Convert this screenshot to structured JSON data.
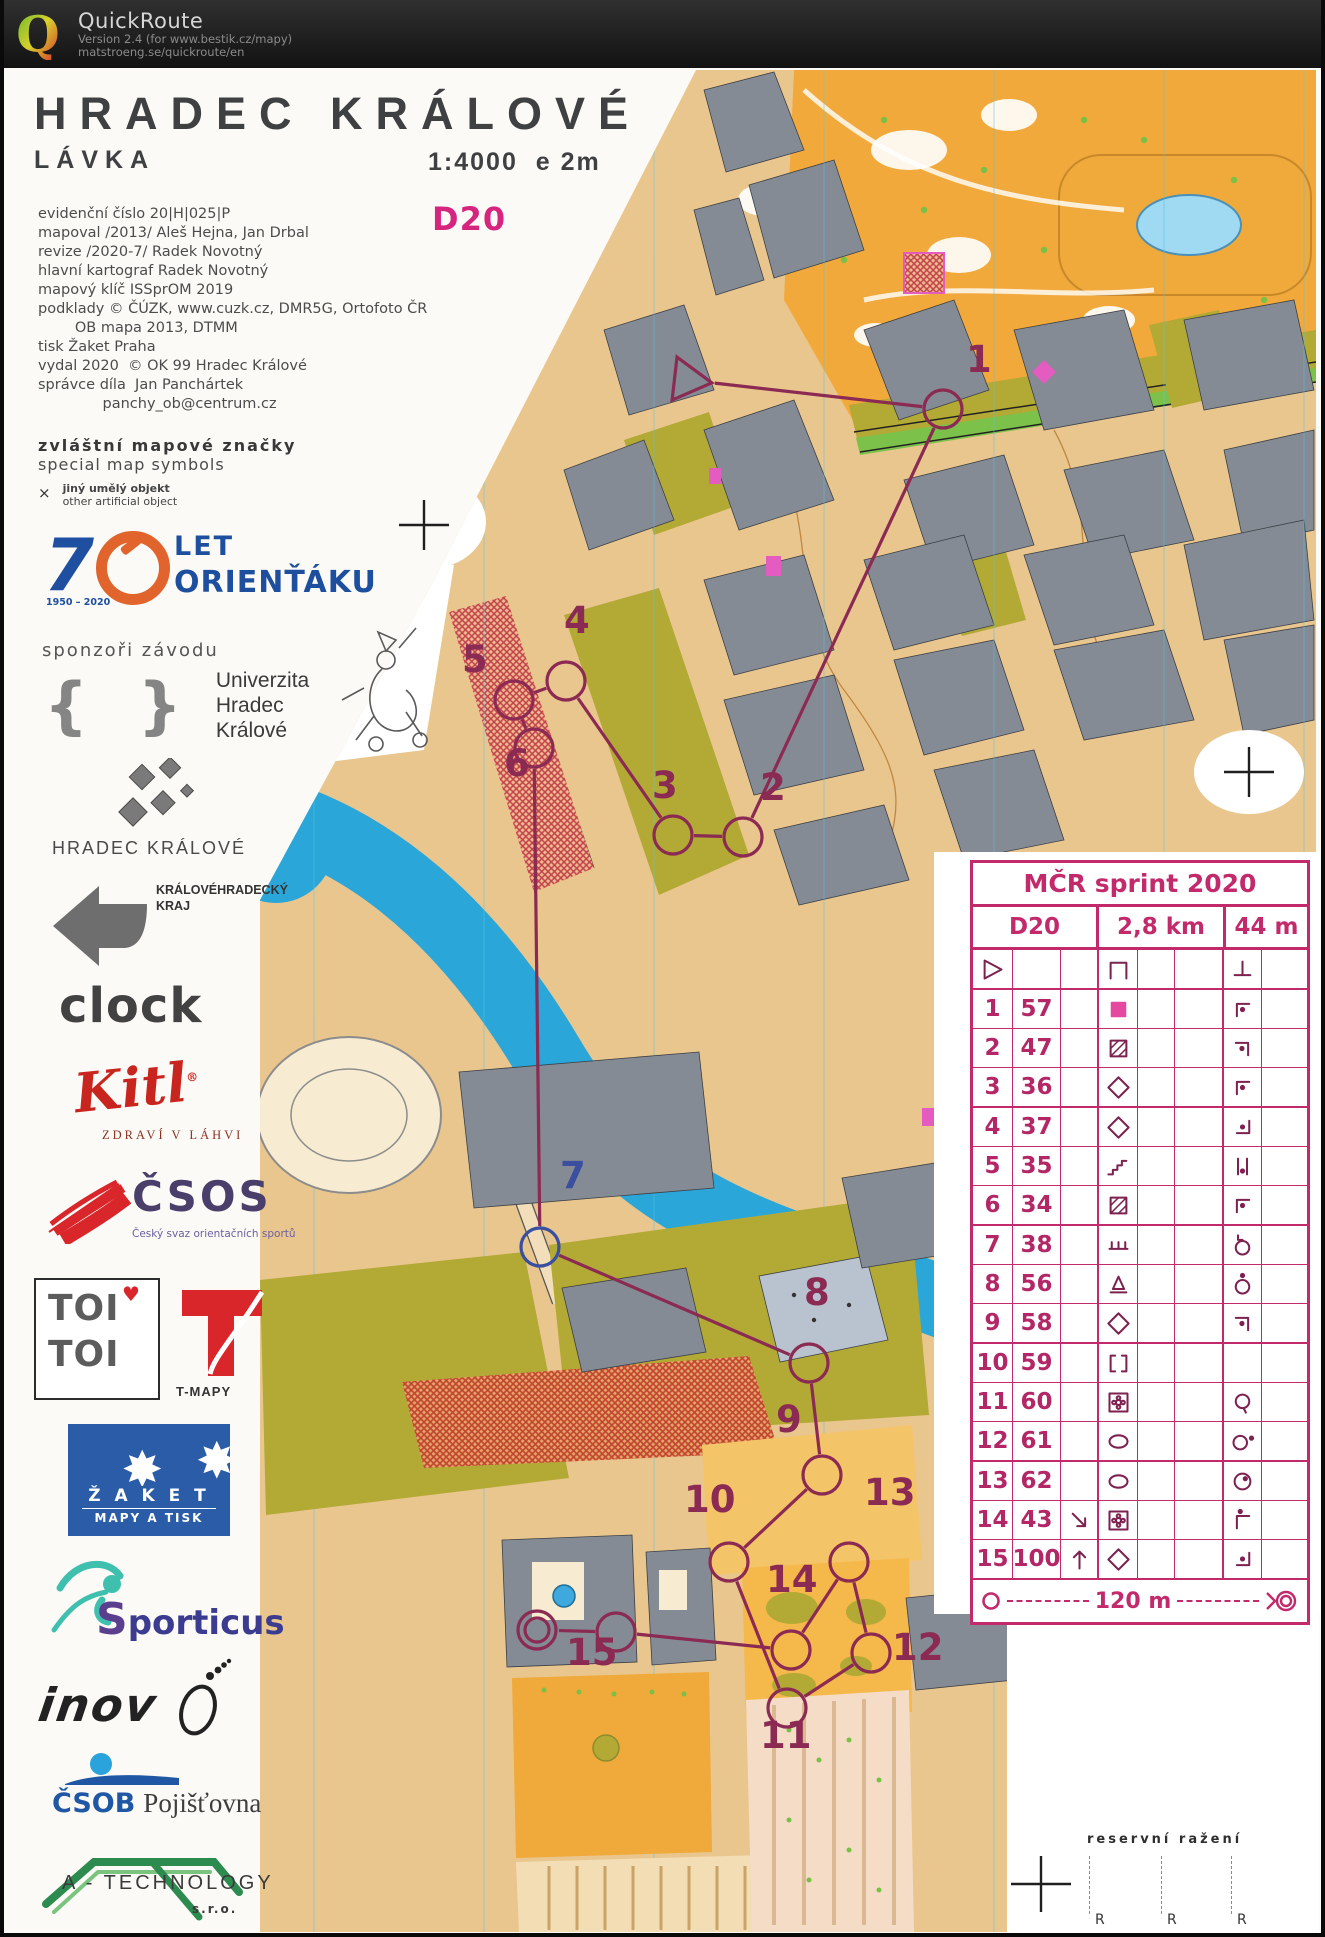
{
  "header": {
    "app": "QuickRoute",
    "version": "Version 2.4  (for www.bestik.cz/mapy)",
    "site": "matstroeng.se/quickroute/en"
  },
  "map_titles": {
    "title": "HRADEC KRÁLOVÉ",
    "subtitle": "LÁVKA",
    "scale": "1:4000",
    "equidistance": "e 2m",
    "course": "D20"
  },
  "imprint": [
    "evidenční číslo 20|H|025|P",
    "mapoval /2013/ Aleš Hejna, Jan Drbal",
    "revize /2020-7/ Radek Novotný",
    "hlavní kartograf Radek Novotný",
    "mapový klíč ISSprOM 2019",
    "podklady © ČÚZK, www.cuzk.cz, DMR5G, Ortofoto ČR",
    "        OB mapa 2013, DTMM",
    "tisk Žaket Praha",
    "vydal 2020  © OK 99 Hradec Králové",
    "správce díla  Jan Panchártek",
    "              panchy_ob@centrum.cz"
  ],
  "special_symbols": {
    "heading_cz": "zvláštní mapové značky",
    "heading_en": "special map symbols",
    "mark": "×",
    "item_cz": "jiný umělý objekt",
    "item_en": "other artificial object"
  },
  "anniversary": {
    "number": "7",
    "years": "1950 – 2020",
    "let": "LET",
    "orientaku": "ORIENŤÁKU"
  },
  "sponsors": {
    "heading": "sponzoři závodu",
    "uhk": {
      "braces": "{ }",
      "lines": [
        "Univerzita",
        "Hradec",
        "Králové"
      ]
    },
    "city": "HRADEC KRÁLOVÉ",
    "kraj_line1": "KRÁLOVÉHRADECKÝ",
    "kraj_line2": "KRAJ",
    "clock": "clock",
    "kitl": "Kitl",
    "kitl_tagline": "ZDRAVÍ V LÁHVI",
    "csos": "ČSOS",
    "csos_tagline": "Český svaz orientačních sportů",
    "toi": "TOI",
    "tmapy": "T-MAPY",
    "zaket": "Ž A K E T",
    "zaket_tagline": "MAPY A TISK",
    "sporticus_initial": "S",
    "sporticus_rest": "porticus",
    "inov": "inov",
    "csob": "ČSOB",
    "csob_suffix": "Pojišťovna",
    "atech": "A - TECHNOLOGY",
    "atech_suffix": "s.r.o."
  },
  "course": {
    "start": {
      "x": 683,
      "y": 380
    },
    "finish": {
      "x": 533,
      "y": 1630
    },
    "controls": [
      {
        "n": "1",
        "x": 939,
        "y": 409,
        "lx": 962,
        "ly": 372
      },
      {
        "n": "2",
        "x": 739,
        "y": 837,
        "lx": 756,
        "ly": 800
      },
      {
        "n": "3",
        "x": 669,
        "y": 835,
        "lx": 648,
        "ly": 798
      },
      {
        "n": "4",
        "x": 562,
        "y": 681,
        "lx": 560,
        "ly": 633
      },
      {
        "n": "5",
        "x": 510,
        "y": 700,
        "lx": 458,
        "ly": 672
      },
      {
        "n": "6",
        "x": 530,
        "y": 748,
        "lx": 500,
        "ly": 776
      },
      {
        "n": "7",
        "x": 536,
        "y": 1247,
        "lx": 556,
        "ly": 1188,
        "color": "#3b4fa0"
      },
      {
        "n": "8",
        "x": 805,
        "y": 1363,
        "lx": 800,
        "ly": 1305
      },
      {
        "n": "9",
        "x": 818,
        "y": 1475,
        "lx": 772,
        "ly": 1432
      },
      {
        "n": "10",
        "x": 725,
        "y": 1562,
        "lx": 680,
        "ly": 1512
      },
      {
        "n": "11",
        "x": 783,
        "y": 1708,
        "lx": 756,
        "ly": 1748
      },
      {
        "n": "12",
        "x": 867,
        "y": 1653,
        "lx": 888,
        "ly": 1660
      },
      {
        "n": "13",
        "x": 845,
        "y": 1562,
        "lx": 860,
        "ly": 1505
      },
      {
        "n": "14",
        "x": 787,
        "y": 1650,
        "lx": 762,
        "ly": 1592
      },
      {
        "n": "15",
        "x": 612,
        "y": 1632,
        "lx": 562,
        "ly": 1665
      }
    ]
  },
  "control_card": {
    "title": "MČR sprint 2020",
    "class": "D20",
    "length": "2,8 km",
    "climb": "44 m",
    "rows": [
      {
        "a": "start",
        "b": "",
        "c": "",
        "d": "canopy",
        "g": "perpendicular"
      },
      {
        "a": "1",
        "b": "57",
        "c": "",
        "d": "building-filled",
        "g": "corner-nw-dot"
      },
      {
        "a": "2",
        "b": "47",
        "c": "",
        "d": "building-hatched",
        "g": "corner-ne-dot"
      },
      {
        "a": "3",
        "b": "36",
        "c": "",
        "d": "diamond",
        "g": "corner-nw-dot"
      },
      {
        "a": "4",
        "b": "37",
        "c": "",
        "d": "diamond",
        "g": "corner-se-dot"
      },
      {
        "a": "5",
        "b": "35",
        "c": "",
        "d": "stairs",
        "g": "between-dot"
      },
      {
        "a": "6",
        "b": "34",
        "c": "",
        "d": "building-hatched",
        "g": "corner-nw-dot"
      },
      {
        "a": "7",
        "b": "38",
        "c": "",
        "d": "wall",
        "g": "circle-corner-top"
      },
      {
        "a": "8",
        "b": "56",
        "c": "",
        "d": "statue",
        "g": "circle-dot-top"
      },
      {
        "a": "9",
        "b": "58",
        "c": "",
        "d": "diamond",
        "g": "corner-ne-dot"
      },
      {
        "a": "10",
        "b": "59",
        "c": "",
        "d": "gate",
        "g": ""
      },
      {
        "a": "11",
        "b": "60",
        "c": "",
        "d": "flower-box",
        "g": "circle-tail"
      },
      {
        "a": "12",
        "b": "61",
        "c": "",
        "d": "ellipse",
        "g": "circle-dot-right"
      },
      {
        "a": "13",
        "b": "62",
        "c": "",
        "d": "ellipse",
        "g": "circle-dot-inside"
      },
      {
        "a": "14",
        "b": "43",
        "c": "arrow-se",
        "d": "flower-box",
        "g": "corner-nw-dot-above"
      },
      {
        "a": "15",
        "b": "100",
        "c": "arrow-n",
        "d": "diamond",
        "g": "corner-se-dot"
      }
    ],
    "footer_distance": "120 m"
  },
  "reserve": {
    "label": "reservní ražení",
    "marks": [
      "R",
      "R",
      "R"
    ]
  },
  "palette": {
    "course": "#8b2a52",
    "card": "#c22a6c",
    "river": "#2ba6d9",
    "building": "#858b94",
    "olive": "#b3a935",
    "orange": "#f2a93b",
    "paved": "#eac68f",
    "pink": "#e45cc0",
    "hatch_red": "#c4404e"
  }
}
